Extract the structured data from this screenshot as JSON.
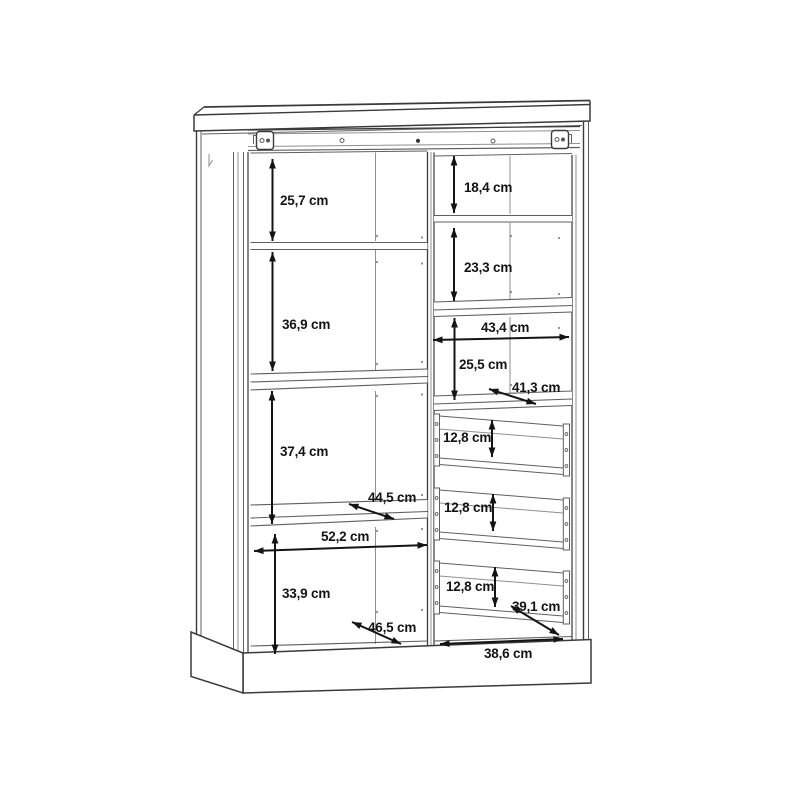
{
  "diagram": {
    "kind": "furniture-dimension-drawing",
    "subject": "two-section cabinet with shelves and drawers",
    "unit": "cm",
    "dimensions": {
      "left_section": {
        "top_shelf_height": "25,7 cm",
        "middle_shelf_height": "36,9 cm",
        "lower_shelf_height": "37,4 cm",
        "bottom_space_height": "33,9 cm",
        "shelf_depth": "44,5 cm",
        "inner_width": "52,2 cm",
        "bottom_depth": "46,5 cm"
      },
      "right_section": {
        "top_space_height": "18,4 cm",
        "second_space_height": "23,3 cm",
        "inner_width": "43,4 cm",
        "third_space_height": "25,5 cm",
        "shelf_depth": "41,3 cm",
        "drawer1_height": "12,8 cm",
        "drawer2_height": "12,8 cm",
        "drawer3_height": "12,8 cm",
        "drawer_depth": "39,1 cm",
        "bottom_inner_width": "38,6 cm"
      }
    },
    "colors": {
      "background": "#ffffff",
      "structure_line": "#3a3a3a",
      "detail_line": "#8f8f8f",
      "dimension_line": "#141414"
    }
  }
}
